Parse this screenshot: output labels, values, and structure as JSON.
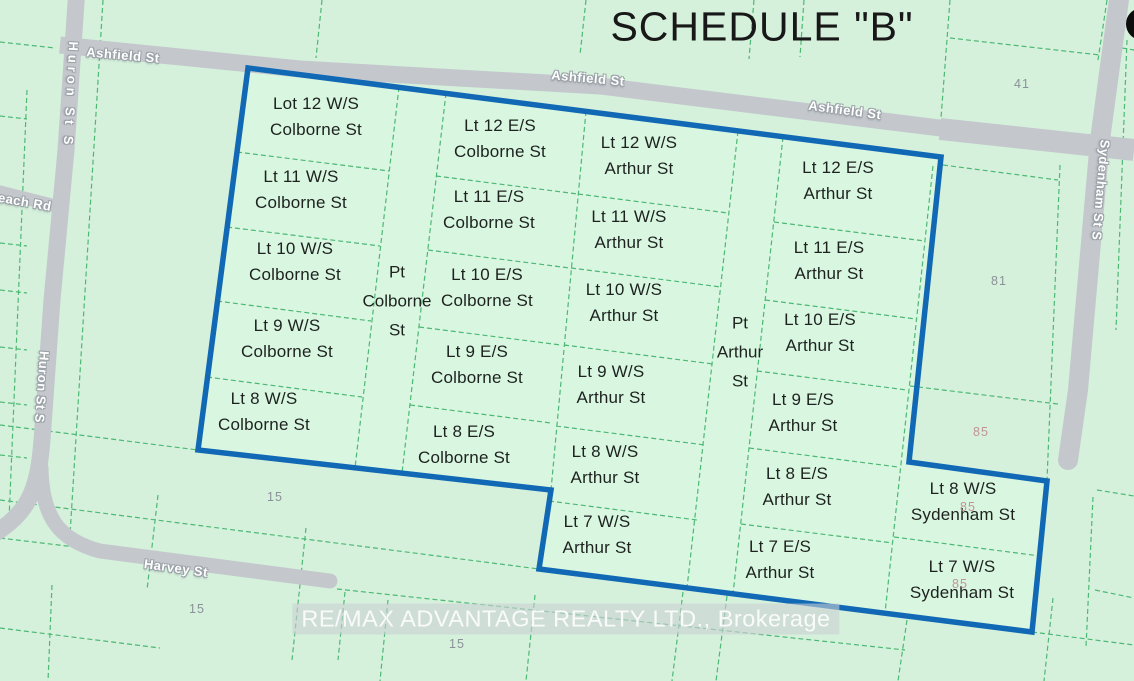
{
  "title": "SCHEDULE \"B\"",
  "watermark": {
    "text": "RE/MAX ADVANTAGE REALTY LTD., Brokerage"
  },
  "colors": {
    "background": "#d5f1dc",
    "selection_fill": "#d9f6e1",
    "boundary_blue": "#1168b4",
    "parcel_line_green": "#4db874",
    "road_gray": "#c4c8cd",
    "lot_text": "#1d221f",
    "parcel_number_gray": "#8b9198",
    "parcel_number_pink": "#c08f94"
  },
  "streets": {
    "ashfield": "Ashfield St",
    "huron": "Huron St S",
    "sydenham": "Sydenham St S",
    "harvey": "Harvey St",
    "beach": "Beach Rd"
  },
  "map": {
    "lot_labels": [
      {
        "t": "Lot 12 W/S\nColborne St",
        "x": 316,
        "y": 117
      },
      {
        "t": "Lt 11 W/S\nColborne St",
        "x": 301,
        "y": 190
      },
      {
        "t": "Lt 10 W/S\nColborne St",
        "x": 295,
        "y": 262
      },
      {
        "t": "Lt 9 W/S\nColborne St",
        "x": 287,
        "y": 339
      },
      {
        "t": "Lt 8 W/S\nColborne St",
        "x": 264,
        "y": 412
      },
      {
        "t": "Lt 12 E/S\nColborne St",
        "x": 500,
        "y": 139
      },
      {
        "t": "Lt 11 E/S\nColborne St",
        "x": 489,
        "y": 210
      },
      {
        "t": "Lt 10 E/S\nColborne St",
        "x": 487,
        "y": 288
      },
      {
        "t": "Lt 9 E/S\nColborne St",
        "x": 477,
        "y": 365
      },
      {
        "t": "Lt 8 E/S\nColborne St",
        "x": 464,
        "y": 445
      },
      {
        "t": "Lt 12 W/S\nArthur St",
        "x": 639,
        "y": 156
      },
      {
        "t": "Lt 11 W/S\nArthur St",
        "x": 629,
        "y": 230
      },
      {
        "t": "Lt 10 W/S\nArthur St",
        "x": 624,
        "y": 303
      },
      {
        "t": "Lt 9 W/S\nArthur St",
        "x": 611,
        "y": 385
      },
      {
        "t": "Lt 8 W/S\nArthur St",
        "x": 605,
        "y": 465
      },
      {
        "t": "Lt 7 W/S\nArthur St",
        "x": 597,
        "y": 535
      },
      {
        "t": "Lt 12 E/S\nArthur St",
        "x": 838,
        "y": 181
      },
      {
        "t": "Lt 11 E/S\nArthur St",
        "x": 829,
        "y": 261
      },
      {
        "t": "Lt 10 E/S\nArthur St",
        "x": 820,
        "y": 333
      },
      {
        "t": "Lt 9 E/S\nArthur St",
        "x": 803,
        "y": 413
      },
      {
        "t": "Lt 8 E/S\nArthur St",
        "x": 797,
        "y": 487
      },
      {
        "t": "Lt 7 E/S\nArthur St",
        "x": 780,
        "y": 560
      },
      {
        "t": "Lt 8 W/S\nSydenham St",
        "x": 963,
        "y": 502
      },
      {
        "t": "Lt 7 W/S\nSydenham St",
        "x": 962,
        "y": 580
      }
    ],
    "street_part_labels": [
      {
        "t": "Pt\nColborne\nSt",
        "x": 397,
        "y": 301
      },
      {
        "t": "Pt\nArthur\nSt",
        "x": 740,
        "y": 352
      }
    ],
    "street_labels": [
      {
        "t": "Ashfield St",
        "x": 123,
        "y": 55,
        "r": 5,
        "ls": 0.5
      },
      {
        "t": "Ashfield St",
        "x": 588,
        "y": 78,
        "r": 5,
        "ls": 0.5
      },
      {
        "t": "Ashfield St",
        "x": 845,
        "y": 110,
        "r": 7.5,
        "ls": 0.5
      },
      {
        "t": "Huron St S",
        "x": 71,
        "y": 95,
        "r": 93,
        "ls": 4
      },
      {
        "t": "Huron St S",
        "x": 42,
        "y": 387,
        "r": 94,
        "ls": 0.5
      },
      {
        "t": "Sydenham St S",
        "x": 1101,
        "y": 190,
        "r": 95,
        "ls": 0.5
      },
      {
        "t": "Harvey St",
        "x": 176,
        "y": 568,
        "r": 8,
        "ls": 0.5
      },
      {
        "t": "Beach Rd",
        "x": 20,
        "y": 201,
        "r": 10,
        "ls": 0.5
      }
    ],
    "parcel_numbers": [
      {
        "t": "41",
        "x": 1022,
        "y": 84,
        "tone": "gray"
      },
      {
        "t": "81",
        "x": 999,
        "y": 281,
        "tone": "gray"
      },
      {
        "t": "85",
        "x": 981,
        "y": 432,
        "tone": "pink"
      },
      {
        "t": "85",
        "x": 968,
        "y": 507,
        "tone": "pink"
      },
      {
        "t": "85",
        "x": 960,
        "y": 584,
        "tone": "pink"
      },
      {
        "t": "15",
        "x": 275,
        "y": 497,
        "tone": "gray"
      },
      {
        "t": "15",
        "x": 197,
        "y": 609,
        "tone": "gray"
      },
      {
        "t": "15",
        "x": 457,
        "y": 644,
        "tone": "gray"
      }
    ]
  }
}
